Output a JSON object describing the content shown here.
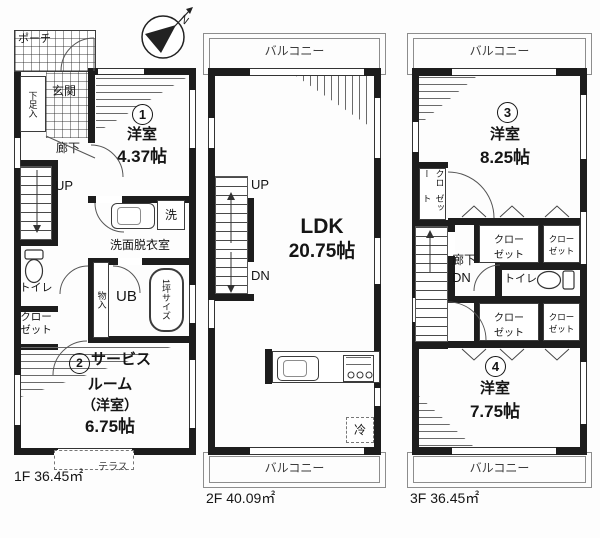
{
  "compass": {
    "north": "N"
  },
  "f1": {
    "area": "1F 36.45㎡",
    "porch": "ポーチ",
    "genkan": "玄関",
    "shoe": "下足入",
    "hall": "廊下",
    "up": "UP",
    "r1num": "1",
    "r1name": "洋室",
    "r1size": "4.37帖",
    "wash": "洗面脱衣室",
    "washer": "洗",
    "toilet": "トイレ",
    "clo1": "クロー",
    "clo2": "ゼット",
    "mono": "物入",
    "ub": "UB",
    "tub": "1坪サイズ",
    "r2num": "2",
    "r2l1": "サービス",
    "r2l2": "ルーム",
    "r2l3": "（洋室）",
    "r2l4": "6.75帖",
    "terrace": "テラス"
  },
  "f2": {
    "area": "2F 40.09㎡",
    "balc": "バルコニー",
    "up": "UP",
    "dn": "DN",
    "ldk": "LDK",
    "ldksize": "20.75帖",
    "fridge": "冷"
  },
  "f3": {
    "area": "3F 36.45㎡",
    "balc": "バルコニー",
    "r3num": "3",
    "r3name": "洋室",
    "r3size": "8.25帖",
    "clo1": "クロー",
    "clo2": "ゼット",
    "hall": "廊下",
    "dn": "DN",
    "toilet": "トイレ",
    "r4num": "4",
    "r4name": "洋室",
    "r4size": "7.75帖"
  }
}
